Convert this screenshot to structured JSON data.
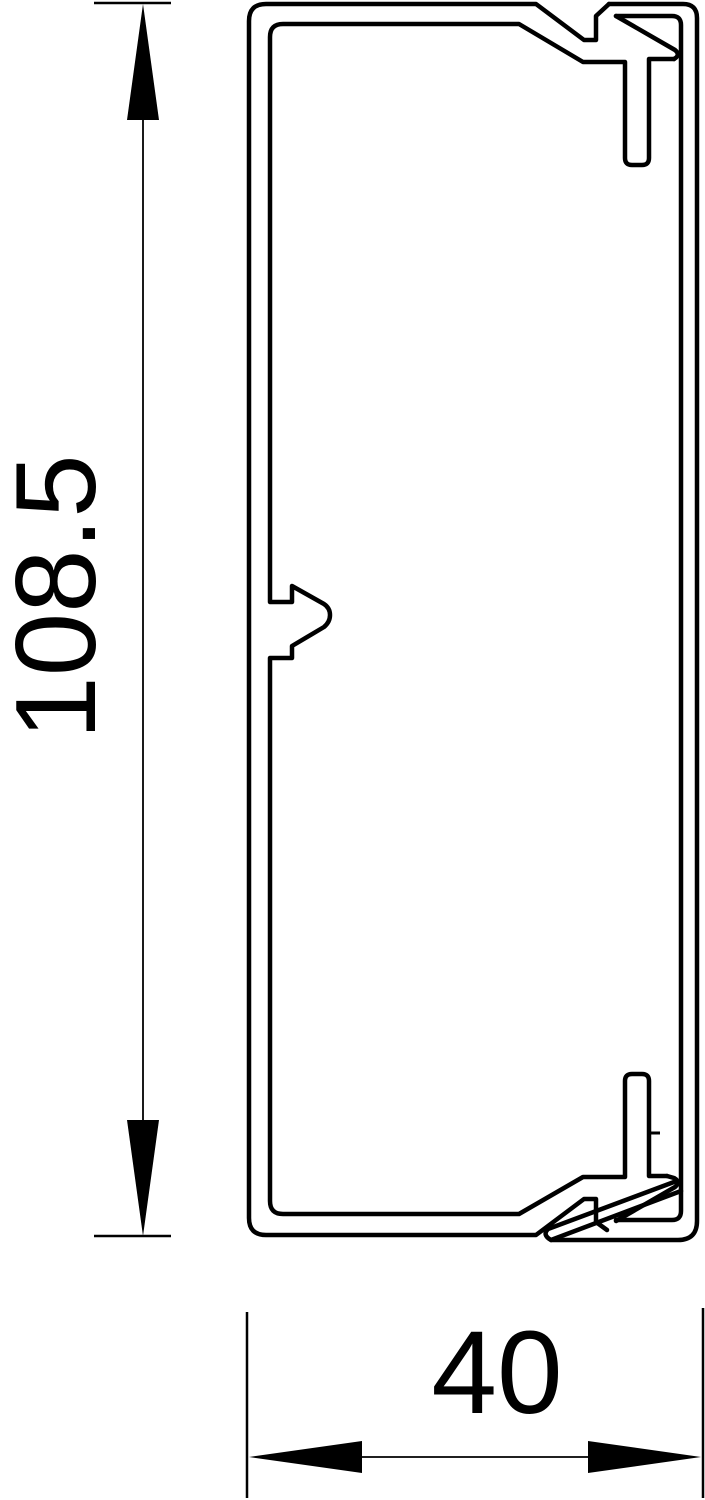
{
  "drawing": {
    "height_dimension": {
      "label": "108.5"
    },
    "width_dimension": {
      "label": "40"
    },
    "line_color": "#000000",
    "background_color": "#ffffff"
  }
}
